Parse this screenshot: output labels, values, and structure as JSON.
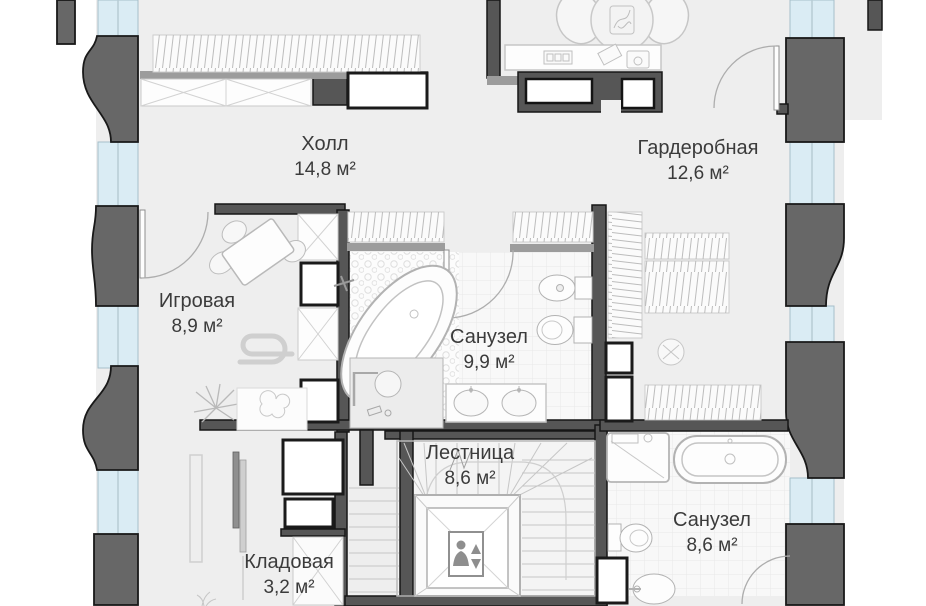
{
  "rooms": [
    {
      "id": "hall",
      "name": "Холл",
      "area": "14,8 м²"
    },
    {
      "id": "wardrobe",
      "name": "Гардеробная",
      "area": "12,6 м²"
    },
    {
      "id": "playroom",
      "name": "Игровая",
      "area": "8,9 м²"
    },
    {
      "id": "bathroom-1",
      "name": "Санузел",
      "area": "9,9 м²"
    },
    {
      "id": "stairs",
      "name": "Лестница",
      "area": "8,6 м²"
    },
    {
      "id": "storage",
      "name": "Кладовая",
      "area": "3,2 м²"
    },
    {
      "id": "bathroom-2",
      "name": "Санузел",
      "area": "8,6 м²"
    }
  ],
  "colors": {
    "wall": "#565656",
    "wall_outline": "#161616",
    "light_wall": "#9c9c9c",
    "glazing": "#daecf4",
    "floor": "#eeeeee",
    "tile_floor": "#f8f8f8",
    "fixture_outline": "#b2b2b2",
    "furniture_outline": "#c6c6c6",
    "label_text": "#3b3b3b"
  }
}
